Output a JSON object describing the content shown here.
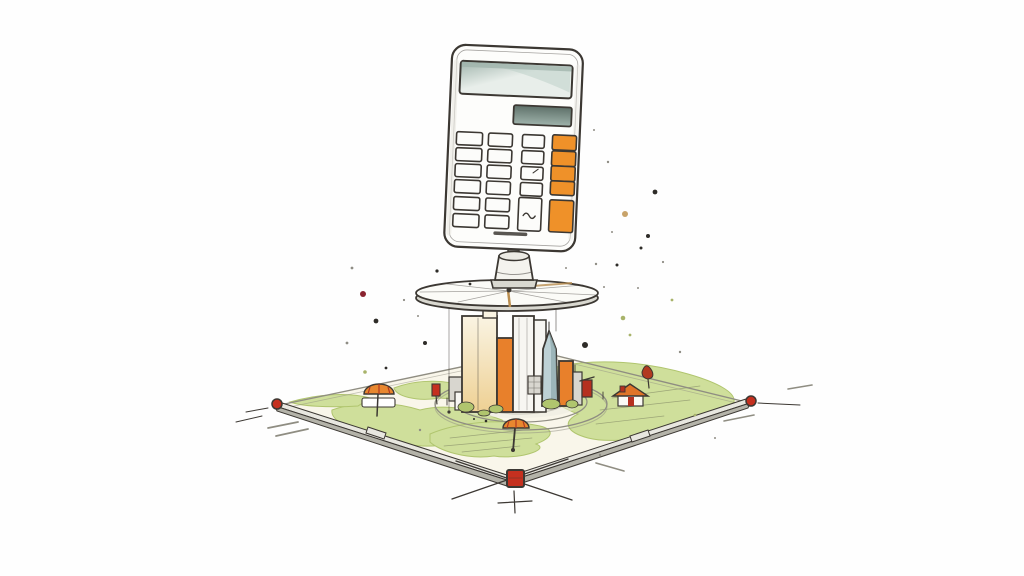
{
  "scene": {
    "type": "hand-drawn watercolor illustration",
    "subject": "calculator mounted on a surveyor turntable pedestal above a miniature city block on a surveyed land plot",
    "elements": [
      "calculator",
      "turntable-disc",
      "pedestal-mount",
      "city-buildings",
      "ring-roads",
      "land-plot",
      "corner-survey-markers",
      "umbrella-trees",
      "houses",
      "paint-splatters"
    ]
  },
  "palette": {
    "background": "#fefefe",
    "ink": "#3c3833",
    "ink_soft": "#8f8d82",
    "calculator_body": "#fdfdfb",
    "calculator_shade": "#e9e7e1",
    "display_dark": "#5e7069",
    "display_mid": "#9fb3ab",
    "display_light": "#e8eeea",
    "display_streak": "#b9cdc6",
    "key_white": "#fcfcfa",
    "key_orange": "#ef9129",
    "key_orange_deep": "#d97414",
    "metal": "#eceae4",
    "disc_face": "#fbfbf7",
    "disc_side": "#d9d8d0",
    "drip_brown": "#b98d4f",
    "building_cream_light": "#faf4e3",
    "building_cream": "#eed093",
    "building_orange": "#e8802b",
    "building_white": "#f7f6f2",
    "building_grey": "#d8d6cf",
    "spire_light": "#bdd1d5",
    "spire_dark": "#8fa9ad",
    "ground": "#f9f6ea",
    "road_top": "#e8e7e0",
    "road_side": "#b4b3a9",
    "green": "#cfdf9b",
    "green_deep": "#b0c56e",
    "marker_red": "#c5301f",
    "roof_orange": "#e07428",
    "house_red": "#b5301f",
    "tree_orange": "#e8872f",
    "tree_red": "#b23a20",
    "splatter_dark": "#2e2c28",
    "splatter_olive": "#a8b36a",
    "splatter_tan": "#c8a36a",
    "splatter_maroon": "#8a2430",
    "splatter_grey": "#8f8d85"
  },
  "calculator": {
    "keypad": {
      "white_columns": [
        {
          "x": 456,
          "w": 26,
          "h": 13,
          "rows": [
            134,
            150,
            166,
            182,
            199,
            216
          ]
        },
        {
          "x": 488,
          "w": 24,
          "h": 13,
          "rows": [
            134,
            150,
            166,
            182,
            199,
            216
          ]
        },
        {
          "x": 522,
          "w": 22,
          "h": 13,
          "rows": [
            134,
            150,
            166,
            182
          ]
        }
      ],
      "orange_keys": [
        {
          "x": 552,
          "y": 133,
          "w": 24,
          "h": 15
        },
        {
          "x": 552,
          "y": 149,
          "w": 24,
          "h": 15
        },
        {
          "x": 552,
          "y": 164,
          "w": 24,
          "h": 15
        },
        {
          "x": 552,
          "y": 179,
          "w": 24,
          "h": 14
        },
        {
          "x": 552,
          "y": 198,
          "w": 24,
          "h": 32
        }
      ],
      "tall_white_key": {
        "x": 521,
        "y": 197,
        "w": 23,
        "h": 33
      }
    }
  },
  "splatters": [
    [
      363,
      294,
      3,
      "splatter_maroon"
    ],
    [
      376,
      321,
      2.4,
      "splatter_dark"
    ],
    [
      425,
      343,
      2,
      "splatter_dark"
    ],
    [
      437,
      271,
      1.6,
      "splatter_dark"
    ],
    [
      470,
      284,
      1.4,
      "splatter_dark"
    ],
    [
      352,
      268,
      1.4,
      "splatter_grey"
    ],
    [
      365,
      372,
      1.8,
      "splatter_olive"
    ],
    [
      347,
      343,
      1.4,
      "splatter_grey"
    ],
    [
      386,
      368,
      1.4,
      "splatter_dark"
    ],
    [
      404,
      300,
      1.1,
      "splatter_grey"
    ],
    [
      418,
      316,
      1,
      "splatter_grey"
    ],
    [
      655,
      192,
      2.4,
      "splatter_dark"
    ],
    [
      648,
      236,
      2,
      "splatter_dark"
    ],
    [
      625,
      214,
      3,
      "splatter_tan"
    ],
    [
      641,
      248,
      1.5,
      "splatter_dark"
    ],
    [
      617,
      265,
      1.5,
      "splatter_dark"
    ],
    [
      596,
      264,
      1.2,
      "splatter_grey"
    ],
    [
      623,
      318,
      2.3,
      "splatter_olive"
    ],
    [
      585,
      345,
      3,
      "splatter_dark"
    ],
    [
      672,
      300,
      1.4,
      "splatter_olive"
    ],
    [
      612,
      232,
      1,
      "splatter_grey"
    ],
    [
      663,
      262,
      1.1,
      "splatter_grey"
    ],
    [
      604,
      287,
      1,
      "splatter_grey"
    ],
    [
      566,
      268,
      1,
      "splatter_grey"
    ],
    [
      638,
      288,
      1,
      "splatter_grey"
    ],
    [
      630,
      335,
      1.4,
      "splatter_olive"
    ],
    [
      680,
      352,
      1.2,
      "splatter_grey"
    ],
    [
      608,
      162,
      1.2,
      "splatter_grey"
    ],
    [
      594,
      130,
      1,
      "splatter_grey"
    ],
    [
      486,
      421,
      1.3,
      "splatter_dark"
    ],
    [
      474,
      419,
      1,
      "splatter_dark"
    ],
    [
      600,
      455,
      1.2,
      "splatter_grey"
    ],
    [
      420,
      430,
      1.2,
      "splatter_grey"
    ],
    [
      695,
      415,
      1.3,
      "splatter_olive"
    ],
    [
      715,
      438,
      1,
      "splatter_grey"
    ]
  ]
}
